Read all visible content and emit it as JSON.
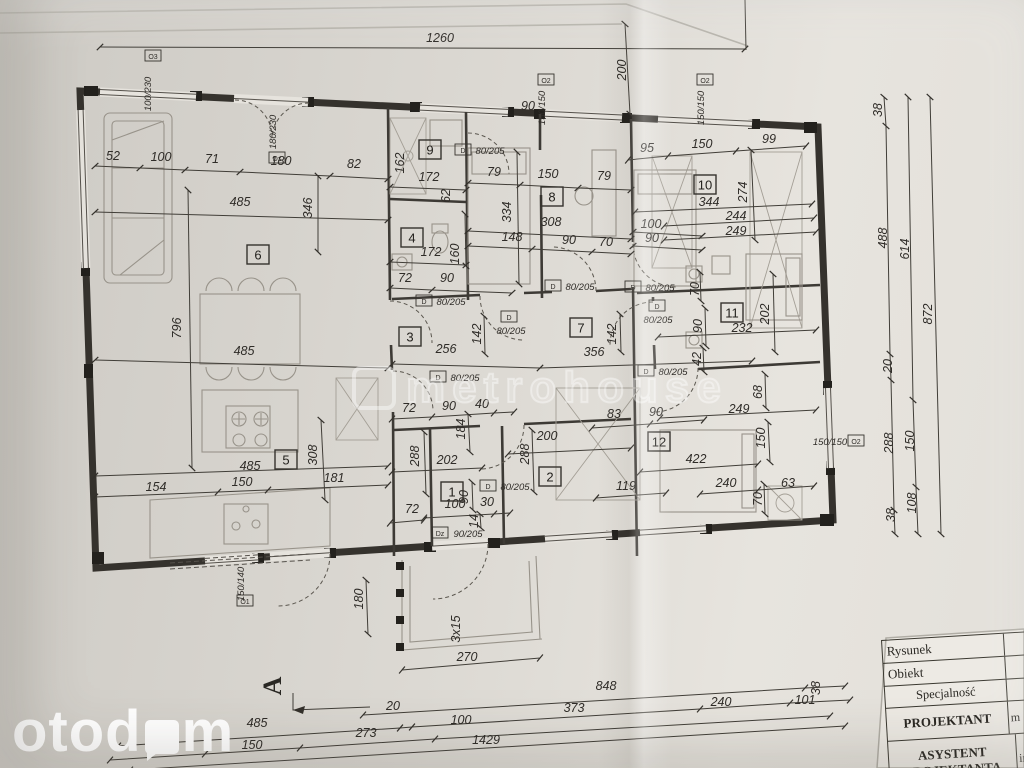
{
  "watermarks": {
    "metro": "metrohouse",
    "oto_prefix": "otod",
    "oto_suffix": "m"
  },
  "section_marker": {
    "label": "A",
    "x": 281,
    "y": 686
  },
  "title_block": {
    "rows": [
      {
        "label": "Rysunek",
        "value": ""
      },
      {
        "label": "Obiekt",
        "value": ""
      },
      {
        "label": "Specjalność",
        "value": ""
      },
      {
        "label": "PROJEKTANT",
        "value": "m"
      },
      {
        "label": "ASYSTENT PROJEKTANTA",
        "value": "in"
      }
    ]
  },
  "rooms": [
    {
      "n": "1",
      "x": 452,
      "y": 492
    },
    {
      "n": "2",
      "x": 550,
      "y": 477
    },
    {
      "n": "3",
      "x": 410,
      "y": 337
    },
    {
      "n": "4",
      "x": 412,
      "y": 238
    },
    {
      "n": "5",
      "x": 286,
      "y": 460
    },
    {
      "n": "6",
      "x": 258,
      "y": 255
    },
    {
      "n": "7",
      "x": 581,
      "y": 328
    },
    {
      "n": "8",
      "x": 552,
      "y": 197
    },
    {
      "n": "9",
      "x": 430,
      "y": 150
    },
    {
      "n": "10",
      "x": 705,
      "y": 185
    },
    {
      "n": "11",
      "x": 732,
      "y": 313
    },
    {
      "n": "12",
      "x": 659,
      "y": 442
    }
  ],
  "openings": [
    {
      "tag": "O3",
      "tx": 153,
      "ty": 56,
      "t": "100/230",
      "x": 151,
      "y": 94,
      "r": 1
    },
    {
      "tag": "Dz",
      "tx": 277,
      "ty": 158,
      "t": "180/230",
      "x": 276,
      "y": 132,
      "r": 1
    },
    {
      "tag": "O2",
      "tx": 546,
      "ty": 80,
      "t": "150/150",
      "x": 545,
      "y": 108,
      "r": 1
    },
    {
      "tag": "O2",
      "tx": 705,
      "ty": 80,
      "t": "150/150",
      "x": 704,
      "y": 108,
      "r": 1
    },
    {
      "tag": "O2",
      "tx": 856,
      "ty": 441,
      "t": "150/150",
      "x": 830,
      "y": 445
    },
    {
      "tag": "O1",
      "tx": 245,
      "ty": 601,
      "t": "150/140",
      "x": 244,
      "y": 584,
      "r": 1
    },
    {
      "tag": "D",
      "tx": 463,
      "ty": 150,
      "t": "80/205",
      "x": 490,
      "y": 154
    },
    {
      "tag": "D",
      "tx": 424,
      "ty": 301,
      "t": "80/205",
      "x": 451,
      "y": 305
    },
    {
      "tag": "D",
      "tx": 509,
      "ty": 317,
      "t": "80/205",
      "x": 511,
      "y": 334
    },
    {
      "tag": "D",
      "tx": 553,
      "ty": 286,
      "t": "80/205",
      "x": 580,
      "y": 290
    },
    {
      "tag": "D",
      "tx": 633,
      "ty": 287,
      "t": "80/205",
      "x": 660,
      "y": 291
    },
    {
      "tag": "D",
      "tx": 657,
      "ty": 306,
      "t": "80/205",
      "x": 658,
      "y": 323
    },
    {
      "tag": "D",
      "tx": 646,
      "ty": 371,
      "t": "80/205",
      "x": 673,
      "y": 375
    },
    {
      "tag": "D",
      "tx": 438,
      "ty": 377,
      "t": "80/205",
      "x": 465,
      "y": 381
    },
    {
      "tag": "D",
      "tx": 488,
      "ty": 486,
      "t": "80/205",
      "x": 515,
      "y": 490
    },
    {
      "tag": "Dz",
      "tx": 440,
      "ty": 533,
      "t": "90/205",
      "x": 468,
      "y": 537
    }
  ],
  "dims": [
    {
      "t": "1260",
      "x": 440,
      "y": 42
    },
    {
      "t": "200",
      "x": 626,
      "y": 70,
      "r": 1
    },
    {
      "t": "52",
      "x": 113,
      "y": 160
    },
    {
      "t": "100",
      "x": 161,
      "y": 161
    },
    {
      "t": "71",
      "x": 212,
      "y": 163
    },
    {
      "t": "180",
      "x": 281,
      "y": 165
    },
    {
      "t": "82",
      "x": 354,
      "y": 168
    },
    {
      "t": "79",
      "x": 494,
      "y": 176
    },
    {
      "t": "150",
      "x": 548,
      "y": 178
    },
    {
      "t": "79",
      "x": 604,
      "y": 180
    },
    {
      "t": "95",
      "x": 647,
      "y": 152
    },
    {
      "t": "150",
      "x": 702,
      "y": 148
    },
    {
      "t": "99",
      "x": 769,
      "y": 143
    },
    {
      "t": "485",
      "x": 240,
      "y": 206
    },
    {
      "t": "346",
      "x": 312,
      "y": 208,
      "r": 1
    },
    {
      "t": "796",
      "x": 181,
      "y": 328,
      "r": 1
    },
    {
      "t": "485",
      "x": 244,
      "y": 355
    },
    {
      "t": "162",
      "x": 404,
      "y": 163,
      "r": 1
    },
    {
      "t": "90",
      "x": 528,
      "y": 110
    },
    {
      "t": "172",
      "x": 429,
      "y": 181
    },
    {
      "t": "62",
      "x": 450,
      "y": 196,
      "r": 1
    },
    {
      "t": "172",
      "x": 431,
      "y": 256
    },
    {
      "t": "160",
      "x": 459,
      "y": 254,
      "r": 1
    },
    {
      "t": "72",
      "x": 405,
      "y": 282
    },
    {
      "t": "90",
      "x": 447,
      "y": 282
    },
    {
      "t": "334",
      "x": 511,
      "y": 212,
      "r": 1
    },
    {
      "t": "308",
      "x": 551,
      "y": 226
    },
    {
      "t": "148",
      "x": 512,
      "y": 241
    },
    {
      "t": "90",
      "x": 569,
      "y": 244
    },
    {
      "t": "70",
      "x": 606,
      "y": 246
    },
    {
      "t": "100",
      "x": 651,
      "y": 228
    },
    {
      "t": "90",
      "x": 652,
      "y": 242
    },
    {
      "t": "344",
      "x": 709,
      "y": 206
    },
    {
      "t": "244",
      "x": 736,
      "y": 220
    },
    {
      "t": "249",
      "x": 736,
      "y": 235
    },
    {
      "t": "274",
      "x": 747,
      "y": 192,
      "r": 1
    },
    {
      "t": "70",
      "x": 699,
      "y": 289,
      "r": 1
    },
    {
      "t": "90",
      "x": 702,
      "y": 326,
      "r": 1
    },
    {
      "t": "232",
      "x": 742,
      "y": 332
    },
    {
      "t": "202",
      "x": 769,
      "y": 314,
      "r": 1
    },
    {
      "t": "42",
      "x": 701,
      "y": 359,
      "r": 1
    },
    {
      "t": "68",
      "x": 762,
      "y": 392,
      "r": 1
    },
    {
      "t": "249",
      "x": 739,
      "y": 413
    },
    {
      "t": "256",
      "x": 446,
      "y": 353
    },
    {
      "t": "142",
      "x": 481,
      "y": 334,
      "r": 1
    },
    {
      "t": "356",
      "x": 594,
      "y": 356
    },
    {
      "t": "142",
      "x": 616,
      "y": 334,
      "r": 1
    },
    {
      "t": "72",
      "x": 409,
      "y": 412
    },
    {
      "t": "90",
      "x": 449,
      "y": 410
    },
    {
      "t": "40",
      "x": 482,
      "y": 408
    },
    {
      "t": "184",
      "x": 465,
      "y": 429,
      "r": 1
    },
    {
      "t": "288",
      "x": 419,
      "y": 456,
      "r": 1
    },
    {
      "t": "202",
      "x": 447,
      "y": 464
    },
    {
      "t": "200",
      "x": 547,
      "y": 440
    },
    {
      "t": "288",
      "x": 529,
      "y": 454,
      "r": 1
    },
    {
      "t": "83",
      "x": 614,
      "y": 418
    },
    {
      "t": "90",
      "x": 656,
      "y": 416
    },
    {
      "t": "119",
      "x": 626,
      "y": 490
    },
    {
      "t": "422",
      "x": 696,
      "y": 463
    },
    {
      "t": "240",
      "x": 726,
      "y": 487
    },
    {
      "t": "63",
      "x": 788,
      "y": 487
    },
    {
      "t": "150",
      "x": 765,
      "y": 438,
      "r": 1
    },
    {
      "t": "70",
      "x": 762,
      "y": 499,
      "r": 1
    },
    {
      "t": "90",
      "x": 468,
      "y": 497,
      "r": 1
    },
    {
      "t": "100",
      "x": 455,
      "y": 508
    },
    {
      "t": "30",
      "x": 487,
      "y": 506
    },
    {
      "t": "72",
      "x": 412,
      "y": 513
    },
    {
      "t": "14",
      "x": 478,
      "y": 521,
      "r": 1,
      "s": 9
    },
    {
      "t": "485",
      "x": 250,
      "y": 470
    },
    {
      "t": "308",
      "x": 317,
      "y": 455,
      "r": 1
    },
    {
      "t": "154",
      "x": 156,
      "y": 491
    },
    {
      "t": "150",
      "x": 242,
      "y": 486
    },
    {
      "t": "181",
      "x": 334,
      "y": 482
    },
    {
      "t": "180",
      "x": 363,
      "y": 599,
      "r": 1
    },
    {
      "t": "270",
      "x": 467,
      "y": 661
    },
    {
      "t": "3x15",
      "x": 460,
      "y": 629,
      "r": 1,
      "s": 8
    },
    {
      "t": "485",
      "x": 257,
      "y": 727
    },
    {
      "t": "150",
      "x": 252,
      "y": 749
    },
    {
      "t": "192",
      "x": 157,
      "y": 754
    },
    {
      "t": "20",
      "x": 393,
      "y": 710
    },
    {
      "t": "273",
      "x": 366,
      "y": 737
    },
    {
      "t": "100",
      "x": 461,
      "y": 724
    },
    {
      "t": "1429",
      "x": 486,
      "y": 744
    },
    {
      "t": "373",
      "x": 574,
      "y": 712
    },
    {
      "t": "848",
      "x": 606,
      "y": 690
    },
    {
      "t": "240",
      "x": 721,
      "y": 706
    },
    {
      "t": "101",
      "x": 805,
      "y": 704
    },
    {
      "t": "38",
      "x": 820,
      "y": 688,
      "r": 1
    },
    {
      "t": "38",
      "x": 882,
      "y": 110,
      "r": 1
    },
    {
      "t": "488",
      "x": 887,
      "y": 238,
      "r": 1
    },
    {
      "t": "20",
      "x": 892,
      "y": 366,
      "r": 1
    },
    {
      "t": "288",
      "x": 893,
      "y": 443,
      "r": 1
    },
    {
      "t": "38",
      "x": 895,
      "y": 515,
      "r": 1
    },
    {
      "t": "614",
      "x": 909,
      "y": 249,
      "r": 1
    },
    {
      "t": "150",
      "x": 914,
      "y": 441,
      "r": 1
    },
    {
      "t": "108",
      "x": 916,
      "y": 503,
      "r": 1
    },
    {
      "t": "872",
      "x": 932,
      "y": 314,
      "r": 1
    }
  ]
}
